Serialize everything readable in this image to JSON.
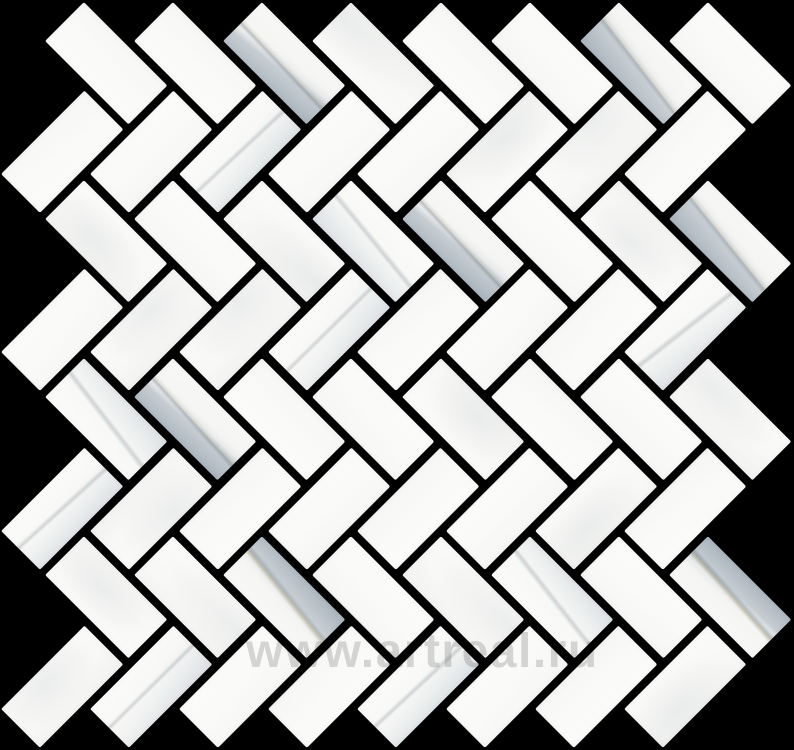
{
  "image": {
    "type": "product-photo",
    "subject": "white marble herringbone mosaic tile sheet on black background"
  },
  "canvas": {
    "width": 794,
    "height": 750,
    "background": "#000000"
  },
  "pattern": {
    "layout": "herringbone-45deg",
    "grid_step_px": 63,
    "grout_px": 8,
    "tile_face_px": {
      "length": 118,
      "width": 55
    },
    "angle_deg": 45,
    "offset_px": {
      "x": -5,
      "y": -4
    },
    "bounds_tolerance_px": 14,
    "cell_range": {
      "n_min": -2,
      "n_max": 16,
      "m_min": -2,
      "m_max": 18
    },
    "seed": 11
  },
  "colors": {
    "background": "#000000",
    "grout": "#000000",
    "tile_white": "#f8f8f6",
    "tile_white_bright": "#fbfbf9",
    "wisp_gray": "#e4e6e5",
    "marble_gray": "#aab4bd",
    "marble_gray_mid": "#c6cdd2",
    "marble_gray_pale": "#dde1e4",
    "vein_dark": "#6e7b85",
    "vein_khaki": "#958f66"
  },
  "marble_map": {
    "heavy_cells": [
      [
        5,
        1
      ],
      [
        13,
        1
      ],
      [
        9,
        5
      ],
      [
        15,
        5
      ],
      [
        3,
        9
      ],
      [
        5,
        13
      ],
      [
        15,
        13
      ]
    ],
    "khaki_cells": [
      [
        5,
        13
      ],
      [
        15,
        13
      ]
    ],
    "medium_cells": [
      [
        4,
        4
      ],
      [
        7,
        5
      ],
      [
        6,
        8
      ],
      [
        14,
        8
      ],
      [
        1,
        9
      ],
      [
        0,
        12
      ],
      [
        11,
        13
      ],
      [
        2,
        16
      ],
      [
        8,
        16
      ]
    ]
  },
  "watermark": {
    "text": "www.artreal.ru",
    "color": "#d6d6d6",
    "font_size_px": 48,
    "left_px": 246,
    "top_px": 624,
    "blend": "multiply"
  }
}
